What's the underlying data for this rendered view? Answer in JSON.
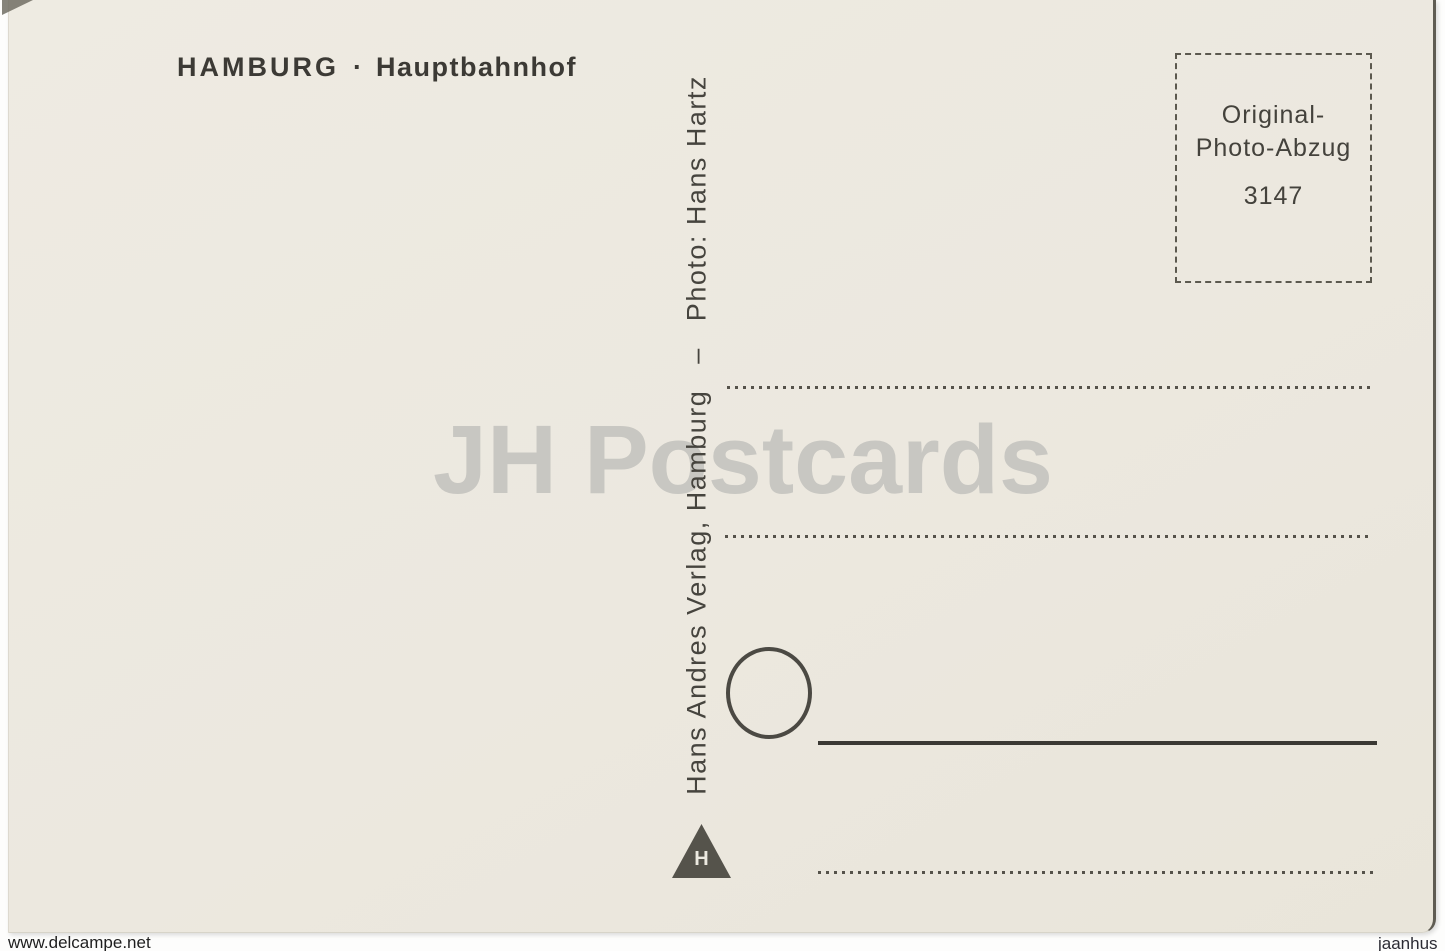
{
  "postcard": {
    "title": {
      "city": "HAMBURG",
      "separator": "·",
      "subject": "Hauptbahnhof"
    },
    "stamp_box": {
      "line1": "Original-",
      "line2": "Photo-Abzug",
      "number": "3147"
    },
    "imprint": {
      "publisher": "Hans Andres Verlag, Hamburg",
      "separator": "–",
      "photo_credit": "Photo: Hans Hartz"
    },
    "publisher_logo": {
      "shape": "triangle-icon",
      "letter": "H"
    },
    "postmark": {
      "shape": "circle-outline-icon"
    }
  },
  "watermark": {
    "text": "JH Postcards"
  },
  "footer": {
    "left": "www.delcampe.net",
    "right": "jaanhus"
  },
  "colors": {
    "card_background": "#ece8df",
    "scan_background": "#fdfdfc",
    "ink": "#46443e",
    "line_ink": "#55524a",
    "watermark": "#c8c7c2",
    "card_edge": "#5f5c53"
  }
}
